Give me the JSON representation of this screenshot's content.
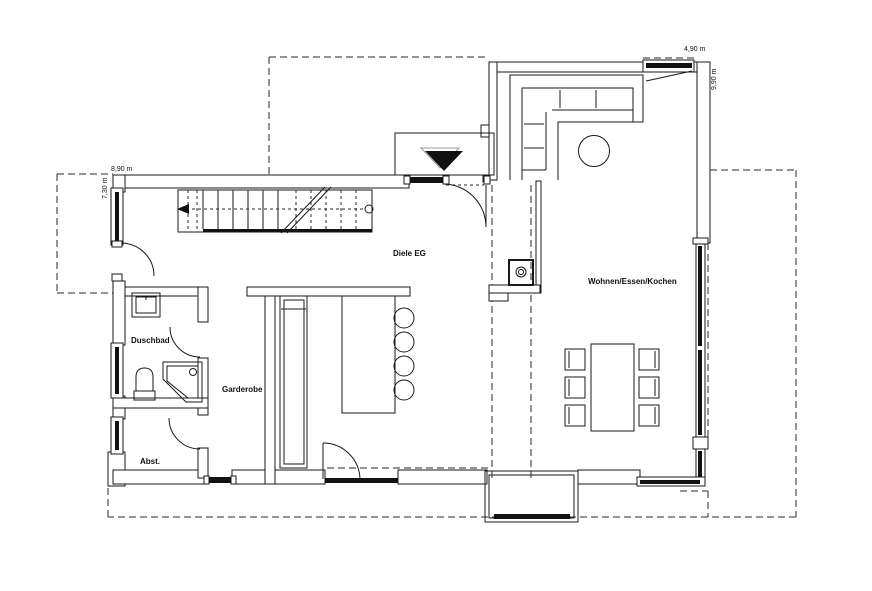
{
  "plan": {
    "rooms": {
      "hall": "Diele EG",
      "living": "Wohnen/Essen/Kochen",
      "bath": "Duschbad",
      "wardrobe": "Garderobe",
      "storage": "Abst."
    },
    "dimensions": {
      "top_left_width": "8,90 m",
      "left_height": "7,30 m",
      "top_right_width": "4,90 m",
      "right_height": "9,90 m"
    },
    "symbols": {
      "entrance_arrow": "entrance-direction-triangle",
      "staircase": "staircase-with-walk-line",
      "stove": "wood-stove",
      "sofa": "corner-sofa",
      "coffee_table": "round-side-table",
      "dining_table": "dining-table-with-6-chairs",
      "island": "kitchen-island-with-4-stools",
      "cabinet": "tall-cabinet",
      "basin": "washbasin",
      "wc": "toilet",
      "shower": "corner-shower"
    },
    "line_colors": {
      "ink": "#1a1a1a",
      "shadow": "#999999"
    }
  }
}
